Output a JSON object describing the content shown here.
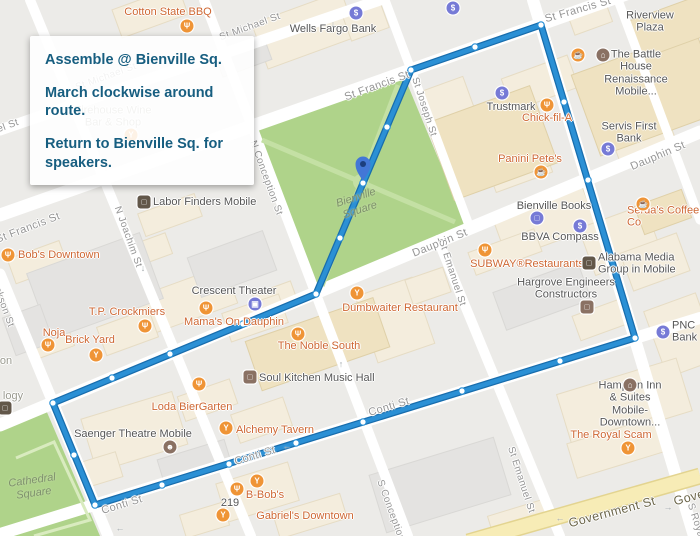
{
  "info_box": {
    "line1": "Assemble @ Bienville Sq.",
    "line2": "March clockwise around route.",
    "line3": "Return to Bienville Sq. for speakers.",
    "text_color": "#175E80"
  },
  "map": {
    "colors": {
      "route": "#2B90D5",
      "route_casing": "#186DAD",
      "node_fill": "#FFFFFF",
      "pin": "#4377D6",
      "pin_inner": "#1C3F7E",
      "icon_orange": "#EF9436",
      "icon_indigo": "#767AD6",
      "icon_brown": "#8A7163",
      "icon_office": "#625749",
      "poi_orange": "#CE6733",
      "poi_dark": "#565656",
      "poi_gray": "#9A9A8F",
      "street_label": "#959595",
      "government_label": "#6B6549",
      "park_label": "#7E906C",
      "park_green": "#AFD38A",
      "road_yellow": "#F7ECB6"
    },
    "icon_glyphs": {
      "restaurant": "Ψ",
      "bar": "Y",
      "cafe": "☕",
      "bank": "$",
      "shopping": "□",
      "theater": "▣",
      "hotel": "⌂",
      "masks": "☻",
      "office": "□"
    },
    "street_labels": [
      {
        "t": "St Michael St",
        "x": 250,
        "y": 27,
        "r": -20,
        "s": 10
      },
      {
        "t": "St Michael St",
        "x": 106,
        "y": 77,
        "r": -20,
        "s": 10
      },
      {
        "t": "el St",
        "x": 8,
        "y": 126,
        "r": -20,
        "s": 10
      },
      {
        "t": "St Francis St",
        "x": 377,
        "y": 86,
        "r": -20,
        "s": 11
      },
      {
        "t": "St Francis St",
        "x": 578,
        "y": 10,
        "r": -16,
        "s": 11
      },
      {
        "t": "St Francis St",
        "x": 28,
        "y": 228,
        "r": -21,
        "s": 11
      },
      {
        "t": "Dauphin St",
        "x": 658,
        "y": 156,
        "r": -23,
        "s": 11
      },
      {
        "t": "Dauphin St",
        "x": 440,
        "y": 243,
        "r": -22,
        "s": 11
      },
      {
        "t": "Conti St",
        "x": 255,
        "y": 456,
        "r": -17,
        "s": 11
      },
      {
        "t": "Conti St",
        "x": 389,
        "y": 407,
        "r": -17,
        "s": 11
      },
      {
        "t": "Conti St",
        "x": 122,
        "y": 505,
        "r": -17,
        "s": 11
      },
      {
        "t": "Government St",
        "x": 612,
        "y": 512,
        "r": -15,
        "s": 12.5,
        "gov": true
      },
      {
        "t": "Government St",
        "x": 717,
        "y": 490,
        "r": -15,
        "s": 12.5,
        "gov": true
      },
      {
        "t": "N Joachim St",
        "x": 128,
        "y": 237,
        "r": 70,
        "s": 10
      },
      {
        "t": "Jackson St",
        "x": 2,
        "y": 302,
        "r": 70,
        "s": 10
      },
      {
        "t": "N Conception St",
        "x": 266,
        "y": 178,
        "r": 70,
        "s": 10
      },
      {
        "t": "S Conception St",
        "x": 393,
        "y": 517,
        "r": 70,
        "s": 10
      },
      {
        "t": "St Joseph St",
        "x": 424,
        "y": 107,
        "r": 72,
        "s": 10
      },
      {
        "t": "St Emanuel St",
        "x": 452,
        "y": 273,
        "r": 72,
        "s": 10
      },
      {
        "t": "St Emanuel St",
        "x": 521,
        "y": 480,
        "r": 72,
        "s": 10
      },
      {
        "t": "S Royal St",
        "x": 698,
        "y": 528,
        "r": 72,
        "s": 10
      }
    ],
    "park_labels": [
      {
        "t": "Bienville\nSquare",
        "x": 358,
        "y": 204,
        "r": -18
      },
      {
        "t": "Cathedral\nSquare",
        "x": 33,
        "y": 487,
        "r": -8
      }
    ],
    "poi_labels": [
      {
        "t": "Cotton State BBQ",
        "x": 168,
        "y": 12,
        "c": "orange"
      },
      {
        "t": "Wells Fargo Bank",
        "x": 333,
        "y": 29,
        "c": "dark"
      },
      {
        "t": "Riverview Plaza",
        "x": 650,
        "y": 22,
        "c": "dark"
      },
      {
        "t": "The Battle House\nRenaissance Mobile...",
        "x": 636,
        "y": 73,
        "c": "dark"
      },
      {
        "t": "Trustmark",
        "x": 511,
        "y": 107,
        "c": "dark"
      },
      {
        "t": "Chick-fil-A",
        "x": 547,
        "y": 118,
        "c": "orange"
      },
      {
        "t": "Servis First Bank",
        "x": 629,
        "y": 133,
        "c": "dark"
      },
      {
        "t": "Panini Pete's",
        "x": 530,
        "y": 159,
        "c": "orange"
      },
      {
        "t": "Firehouse Wine\nBar & Shop",
        "x": 113,
        "y": 117,
        "c": "gray"
      },
      {
        "t": "Labor Finders Mobile",
        "x": 153,
        "y": 202,
        "c": "dark",
        "a": "left"
      },
      {
        "t": "Bienville Books",
        "x": 554,
        "y": 206,
        "c": "dark"
      },
      {
        "t": "Serda's Coffee Co",
        "x": 627,
        "y": 217,
        "c": "orange",
        "a": "left"
      },
      {
        "t": "BBVA Compass",
        "x": 560,
        "y": 237,
        "c": "dark"
      },
      {
        "t": "SUBWAY®Restaurants",
        "x": 527,
        "y": 264,
        "c": "orange"
      },
      {
        "t": "Alabama Media\nGroup in Mobile",
        "x": 598,
        "y": 264,
        "c": "dark",
        "a": "left"
      },
      {
        "t": "Hargrove Engineers\nConstructors",
        "x": 566,
        "y": 289,
        "c": "dark"
      },
      {
        "t": "PNC Bank",
        "x": 672,
        "y": 332,
        "c": "dark",
        "a": "left"
      },
      {
        "t": "Bob's Downtown",
        "x": 18,
        "y": 255,
        "c": "orange",
        "a": "left"
      },
      {
        "t": "T.P. Crockmiers",
        "x": 127,
        "y": 312,
        "c": "orange"
      },
      {
        "t": "Noja",
        "x": 54,
        "y": 333,
        "c": "orange"
      },
      {
        "t": "Brick Yard",
        "x": 90,
        "y": 340,
        "c": "orange"
      },
      {
        "t": "Crescent Theater",
        "x": 234,
        "y": 291,
        "c": "dark"
      },
      {
        "t": "Mama's On Dauphin",
        "x": 234,
        "y": 322,
        "c": "orange"
      },
      {
        "t": "Dumbwaiter Restaurant",
        "x": 400,
        "y": 308,
        "c": "orange"
      },
      {
        "t": "The Noble South",
        "x": 319,
        "y": 346,
        "c": "orange"
      },
      {
        "t": "Soul Kitchen Music Hall",
        "x": 259,
        "y": 378,
        "c": "dark",
        "a": "left"
      },
      {
        "t": "Loda BierGarten",
        "x": 192,
        "y": 407,
        "c": "orange"
      },
      {
        "t": "Alchemy Tavern",
        "x": 236,
        "y": 430,
        "c": "orange",
        "a": "left"
      },
      {
        "t": "Saenger Theatre Mobile",
        "x": 133,
        "y": 434,
        "c": "dark"
      },
      {
        "t": "Hampton Inn & Suites\nMobile- Downtown...",
        "x": 630,
        "y": 404,
        "c": "dark"
      },
      {
        "t": "The Royal Scam",
        "x": 611,
        "y": 435,
        "c": "orange"
      },
      {
        "t": "B-Bob's",
        "x": 265,
        "y": 495,
        "c": "orange"
      },
      {
        "t": "219",
        "x": 230,
        "y": 503,
        "c": "dark"
      },
      {
        "t": "Gabriel's Downtown",
        "x": 305,
        "y": 516,
        "c": "orange"
      },
      {
        "t": "logy",
        "x": 13,
        "y": 396,
        "c": "gray"
      },
      {
        "t": "on",
        "x": 6,
        "y": 361,
        "c": "gray"
      }
    ],
    "icons": [
      {
        "k": "restaurant",
        "x": 187,
        "y": 26,
        "p": "orange"
      },
      {
        "k": "bar",
        "x": 131,
        "y": 135,
        "p": "orange"
      },
      {
        "k": "restaurant",
        "x": 8,
        "y": 255,
        "p": "orange"
      },
      {
        "k": "restaurant",
        "x": 145,
        "y": 326,
        "p": "orange"
      },
      {
        "k": "restaurant",
        "x": 48,
        "y": 345,
        "p": "orange"
      },
      {
        "k": "bar",
        "x": 96,
        "y": 355,
        "p": "orange"
      },
      {
        "k": "restaurant",
        "x": 206,
        "y": 308,
        "p": "orange"
      },
      {
        "k": "bar",
        "x": 357,
        "y": 293,
        "p": "orange"
      },
      {
        "k": "restaurant",
        "x": 298,
        "y": 334,
        "p": "orange"
      },
      {
        "k": "restaurant",
        "x": 199,
        "y": 384,
        "p": "orange"
      },
      {
        "k": "bar",
        "x": 226,
        "y": 428,
        "p": "orange"
      },
      {
        "k": "bar",
        "x": 257,
        "y": 481,
        "p": "orange"
      },
      {
        "k": "restaurant",
        "x": 237,
        "y": 489,
        "p": "orange"
      },
      {
        "k": "bar",
        "x": 223,
        "y": 515,
        "p": "orange"
      },
      {
        "k": "restaurant",
        "x": 547,
        "y": 105,
        "p": "orange"
      },
      {
        "k": "restaurant",
        "x": 485,
        "y": 250,
        "p": "orange"
      },
      {
        "k": "cafe",
        "x": 541,
        "y": 172,
        "p": "orange"
      },
      {
        "k": "cafe",
        "x": 643,
        "y": 204,
        "p": "orange"
      },
      {
        "k": "cafe",
        "x": 578,
        "y": 55,
        "p": "orange"
      },
      {
        "k": "bar",
        "x": 628,
        "y": 448,
        "p": "orange"
      },
      {
        "k": "bank",
        "x": 356,
        "y": 13,
        "p": "indigo"
      },
      {
        "k": "bank",
        "x": 453,
        "y": 8,
        "p": "indigo"
      },
      {
        "k": "bank",
        "x": 502,
        "y": 93,
        "p": "indigo"
      },
      {
        "k": "bank",
        "x": 608,
        "y": 149,
        "p": "indigo"
      },
      {
        "k": "bank",
        "x": 580,
        "y": 226,
        "p": "indigo"
      },
      {
        "k": "bank",
        "x": 663,
        "y": 332,
        "p": "indigo"
      },
      {
        "k": "shopping",
        "x": 537,
        "y": 218,
        "p": "indigo"
      },
      {
        "k": "theater",
        "x": 255,
        "y": 304,
        "p": "indigo"
      },
      {
        "k": "hotel",
        "x": 603,
        "y": 55,
        "p": "brown"
      },
      {
        "k": "hotel",
        "x": 630,
        "y": 385,
        "p": "brown"
      },
      {
        "k": "masks",
        "x": 170,
        "y": 447,
        "p": "brown"
      },
      {
        "k": "office",
        "x": 250,
        "y": 377,
        "p": "brown",
        "sq": true
      },
      {
        "k": "office",
        "x": 587,
        "y": 307,
        "p": "brown",
        "sq": true
      },
      {
        "k": "office",
        "x": 144,
        "y": 202,
        "p": "office",
        "sq": true
      },
      {
        "k": "office",
        "x": 589,
        "y": 263,
        "p": "office",
        "sq": true
      },
      {
        "k": "office",
        "x": 5,
        "y": 408,
        "p": "office",
        "sq": true
      }
    ],
    "arrows": [
      {
        "t": "↓",
        "x": 333,
        "y": 24
      },
      {
        "t": "↓",
        "x": 143,
        "y": 268
      },
      {
        "t": "↑",
        "x": 341,
        "y": 364
      },
      {
        "t": "←",
        "x": 287,
        "y": 446
      },
      {
        "t": "←",
        "x": 120,
        "y": 528
      },
      {
        "t": "←",
        "x": 560,
        "y": 518
      },
      {
        "t": "→",
        "x": 668,
        "y": 507
      }
    ],
    "route": {
      "vertices": [
        [
          411,
          70
        ],
        [
          541,
          25
        ],
        [
          635,
          338
        ],
        [
          95,
          505
        ],
        [
          53,
          403
        ],
        [
          316,
          294
        ]
      ],
      "nodes": [
        [
          411,
          70
        ],
        [
          475,
          47
        ],
        [
          541,
          25
        ],
        [
          564,
          102
        ],
        [
          588,
          180
        ],
        [
          611,
          259
        ],
        [
          635,
          338
        ],
        [
          560,
          361
        ],
        [
          462,
          391
        ],
        [
          363,
          422
        ],
        [
          296,
          443
        ],
        [
          229,
          464
        ],
        [
          162,
          485
        ],
        [
          95,
          505
        ],
        [
          74,
          455
        ],
        [
          53,
          403
        ],
        [
          112,
          378
        ],
        [
          170,
          354
        ],
        [
          243,
          324
        ],
        [
          316,
          294
        ],
        [
          340,
          238
        ],
        [
          363,
          183
        ],
        [
          387,
          127
        ]
      ],
      "pin": {
        "x": 363,
        "y": 164,
        "tip_y": 181
      }
    }
  }
}
